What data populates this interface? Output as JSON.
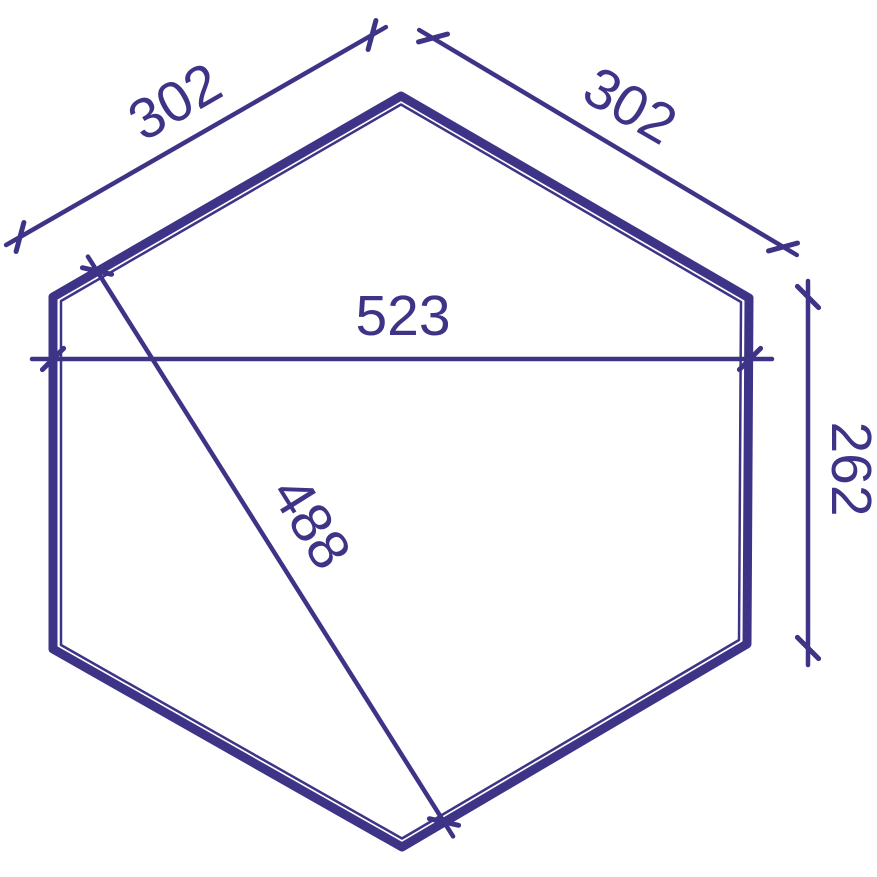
{
  "diagram": {
    "type": "dimensioned-floor-plan",
    "shape": "hexagon",
    "line_color": "#3e3487",
    "background_color": "#ffffff",
    "labels": {
      "dim_top_left_edge": "302",
      "dim_top_right_edge": "302",
      "dim_width": "523",
      "dim_diagonal": "488",
      "dim_right_side": "262"
    }
  }
}
